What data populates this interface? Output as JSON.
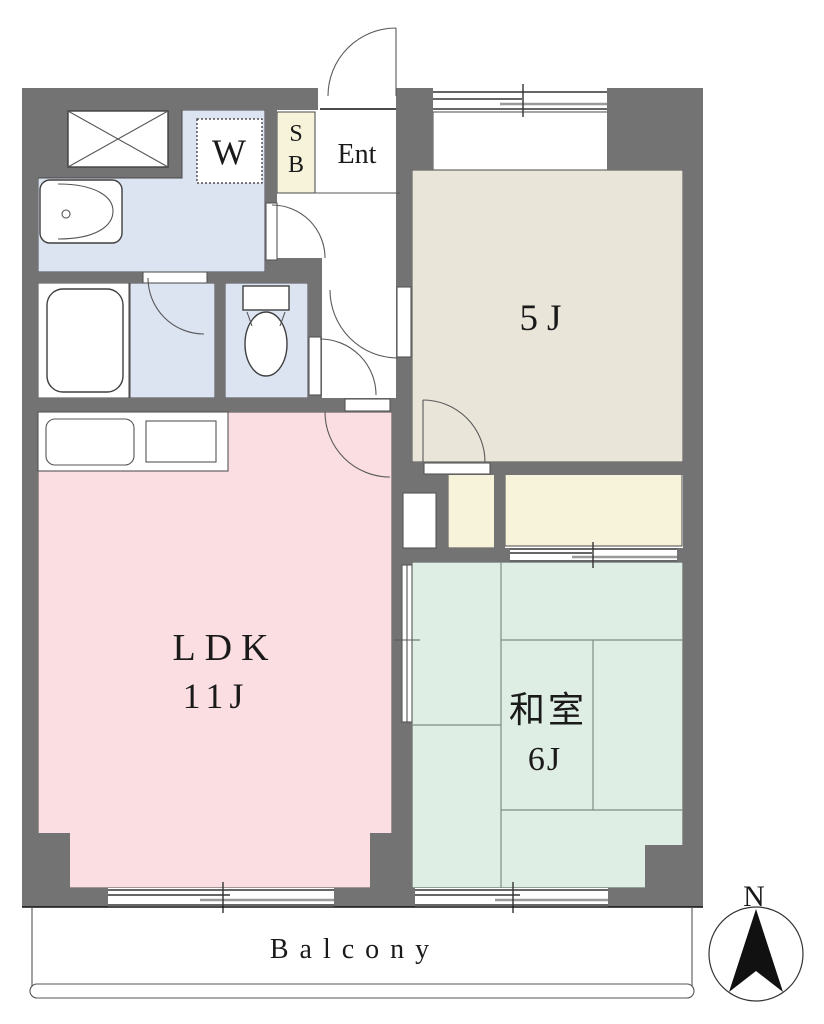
{
  "title": "1LDK apartment floor plan",
  "colors": {
    "wall": "#737373",
    "washroom_blue": "#dce3f1",
    "ldk_pink": "#fbdee2",
    "western_beige": "#e9e5d9",
    "japanese_green": "#dfeee5",
    "storage_cream": "#f6f3da",
    "white": "#ffffff",
    "compass_black": "#111111"
  },
  "labels": {
    "closet": "W",
    "shoe_box_line1": "S",
    "shoe_box_line2": "B",
    "entrance": "Ent",
    "western_room": "5J",
    "ldk_name": "LDK",
    "ldk_size": "11J",
    "japanese_room_name": "和室",
    "japanese_room_size": "6J",
    "balcony": "Balcony",
    "compass_north": "N"
  }
}
